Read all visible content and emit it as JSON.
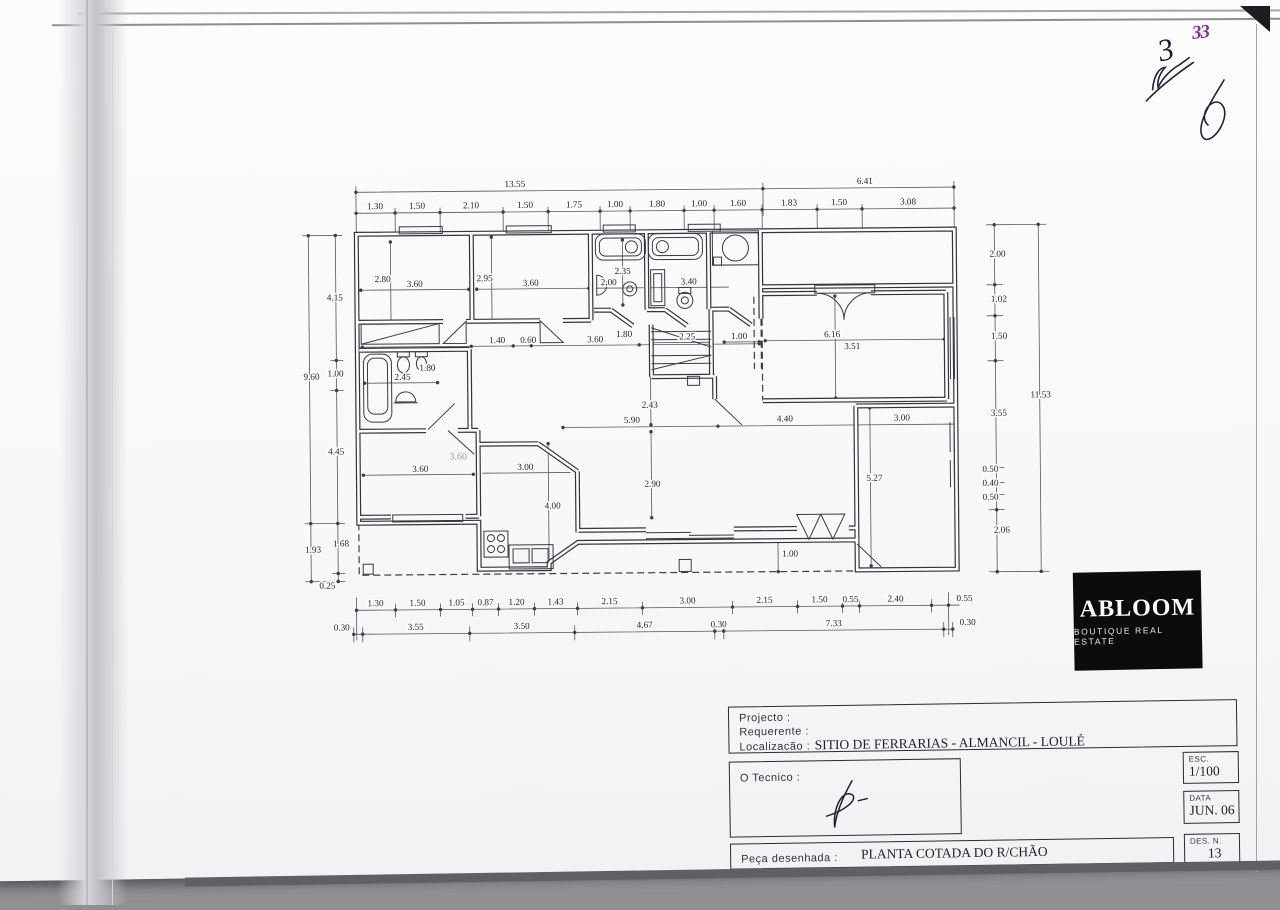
{
  "scan": {
    "purple_mark": "33",
    "pen_mark": "3"
  },
  "logo": {
    "name": "ABLOOM",
    "tagline": "BOUTIQUE REAL ESTATE"
  },
  "title_block": {
    "projecto_label": "Projecto  :",
    "requerente_label": "Requerente  :",
    "localizacao_label": "Localizacão  :",
    "localizacao_value": "SITIO DE FERRARIAS -  ALMANCIL - LOULÉ",
    "tecnico_label": "O  Tecnico  :",
    "esc_label": "ESC.",
    "esc_value": "1/100",
    "data_label": "DATA",
    "data_value": "JUN. 06",
    "des_label": "DES.  N.",
    "des_value": "13",
    "peca_label": "Peça  desenhada  :",
    "peca_value": "PLANTA COTADA DO R/CHÃO"
  },
  "plan": {
    "drawing_title": "PLANTA COTADA DO R/CHÃO",
    "scale": "1/100",
    "dimensions": [
      {
        "x": 217,
        "y": 16,
        "t": "13.55"
      },
      {
        "x": 567,
        "y": 16,
        "t": "6.41"
      },
      {
        "x": 77,
        "y": 37,
        "t": "1.30"
      },
      {
        "x": 119,
        "y": 37,
        "t": "1.50"
      },
      {
        "x": 173,
        "y": 37,
        "t": "2.10"
      },
      {
        "x": 227,
        "y": 37,
        "t": "1.50"
      },
      {
        "x": 276,
        "y": 37,
        "t": "1.75"
      },
      {
        "x": 317,
        "y": 37,
        "t": "1.00"
      },
      {
        "x": 359,
        "y": 37,
        "t": "1.80"
      },
      {
        "x": 401,
        "y": 37,
        "t": "1.00"
      },
      {
        "x": 440,
        "y": 37,
        "t": "1.60"
      },
      {
        "x": 491,
        "y": 37,
        "t": "1.83"
      },
      {
        "x": 541,
        "y": 37,
        "t": "1.50"
      },
      {
        "x": 610,
        "y": 37,
        "t": "3.08"
      },
      {
        "x": 12,
        "y": 207,
        "t": "9.60"
      },
      {
        "x": 12,
        "y": 380,
        "t": "1.93"
      },
      {
        "x": 36,
        "y": 128,
        "t": "4.15"
      },
      {
        "x": 36,
        "y": 204,
        "t": "1.00"
      },
      {
        "x": 36,
        "y": 282,
        "t": "4.45"
      },
      {
        "x": 40,
        "y": 374,
        "t": "1.68"
      },
      {
        "x": 26,
        "y": 416,
        "t": "0.25"
      },
      {
        "x": 699,
        "y": 90,
        "t": "2.00"
      },
      {
        "x": 700,
        "y": 135,
        "t": "1.02"
      },
      {
        "x": 700,
        "y": 172,
        "t": "1.50"
      },
      {
        "x": 699,
        "y": 249,
        "t": "3.55"
      },
      {
        "x": 690,
        "y": 305,
        "t": "0.50"
      },
      {
        "x": 690,
        "y": 319,
        "t": "0.40"
      },
      {
        "x": 690,
        "y": 333,
        "t": "0.50"
      },
      {
        "x": 701,
        "y": 366,
        "t": "2.06"
      },
      {
        "x": 741,
        "y": 231,
        "t": "11.53"
      },
      {
        "x": 74,
        "y": 434,
        "t": "1.30"
      },
      {
        "x": 116,
        "y": 434,
        "t": "1.50"
      },
      {
        "x": 155,
        "y": 434,
        "t": "1.05"
      },
      {
        "x": 184,
        "y": 434,
        "t": "0.87"
      },
      {
        "x": 215,
        "y": 434,
        "t": "1.20"
      },
      {
        "x": 254,
        "y": 434,
        "t": "1.43"
      },
      {
        "x": 308,
        "y": 434,
        "t": "2.15"
      },
      {
        "x": 386,
        "y": 434,
        "t": "3.00"
      },
      {
        "x": 463,
        "y": 434,
        "t": "2.15"
      },
      {
        "x": 518,
        "y": 434,
        "t": "1.50"
      },
      {
        "x": 549,
        "y": 434,
        "t": "0.55"
      },
      {
        "x": 594,
        "y": 434,
        "t": "2.40"
      },
      {
        "x": 663,
        "y": 434,
        "t": "0.55"
      },
      {
        "x": 40,
        "y": 458,
        "t": "0.30"
      },
      {
        "x": 114,
        "y": 458,
        "t": "3.55"
      },
      {
        "x": 220,
        "y": 458,
        "t": "3.50"
      },
      {
        "x": 343,
        "y": 458,
        "t": "4.67"
      },
      {
        "x": 417,
        "y": 458,
        "t": "0.30"
      },
      {
        "x": 532,
        "y": 458,
        "t": "7.33"
      },
      {
        "x": 666,
        "y": 458,
        "t": "0.30"
      },
      {
        "x": 84,
        "y": 110,
        "t": "2.80"
      },
      {
        "x": 116,
        "y": 115,
        "t": "3.60"
      },
      {
        "x": 186,
        "y": 110,
        "t": "2.95"
      },
      {
        "x": 232,
        "y": 115,
        "t": "3.60"
      },
      {
        "x": 324,
        "y": 104,
        "t": "2.35"
      },
      {
        "x": 310,
        "y": 115,
        "t": "2.00"
      },
      {
        "x": 390,
        "y": 115,
        "t": "3.40"
      },
      {
        "x": 198,
        "y": 172,
        "t": "1.40"
      },
      {
        "x": 229,
        "y": 172,
        "t": "0.60"
      },
      {
        "x": 296,
        "y": 172,
        "t": "3.60"
      },
      {
        "x": 325,
        "y": 167,
        "t": "1.80"
      },
      {
        "x": 388,
        "y": 170,
        "t": "2.25"
      },
      {
        "x": 440,
        "y": 170,
        "t": "1.00"
      },
      {
        "x": 533,
        "y": 169,
        "t": "6.16"
      },
      {
        "x": 553,
        "y": 181,
        "t": "3.51"
      },
      {
        "x": 103,
        "y": 208,
        "t": "2.45"
      },
      {
        "x": 128,
        "y": 199,
        "t": "1.80"
      },
      {
        "x": 120,
        "y": 300,
        "t": "3.60"
      },
      {
        "x": 158,
        "y": 288,
        "t": "3.60",
        "c": "pencil"
      },
      {
        "x": 225,
        "y": 299,
        "t": "3.00"
      },
      {
        "x": 252,
        "y": 338,
        "t": "4.00"
      },
      {
        "x": 350,
        "y": 238,
        "t": "2.43"
      },
      {
        "x": 332,
        "y": 253,
        "t": "5.90"
      },
      {
        "x": 352,
        "y": 317,
        "t": "2.90"
      },
      {
        "x": 485,
        "y": 253,
        "t": "4.40"
      },
      {
        "x": 602,
        "y": 253,
        "t": "3.00"
      },
      {
        "x": 574,
        "y": 313,
        "t": "5.27"
      },
      {
        "x": 489,
        "y": 388,
        "t": "1.00"
      }
    ]
  }
}
